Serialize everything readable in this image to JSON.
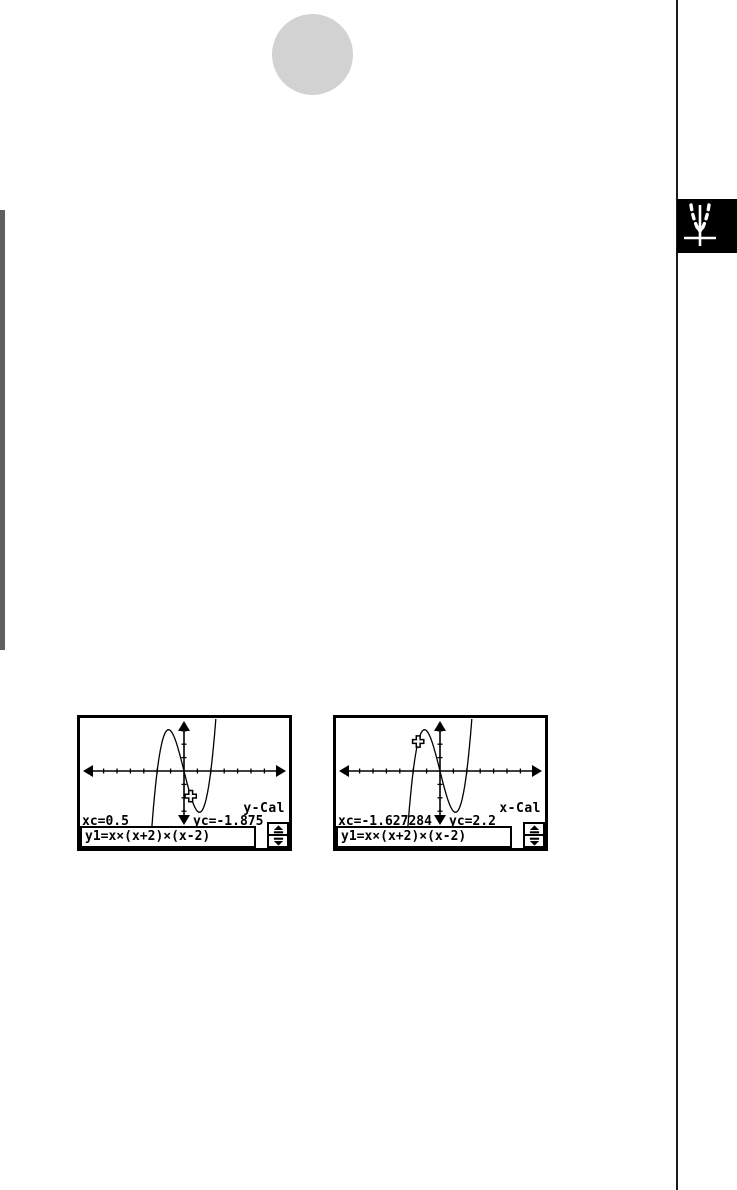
{
  "page": {
    "background": "#ffffff",
    "decorations": {
      "dot_color": "#d2d2d2",
      "side_tab_color": "#606060",
      "rule_color": "#1a1a1a",
      "chapter_tab_bg": "#000000",
      "chapter_tab_icon": "parabola-graph-icon"
    }
  },
  "screens": [
    {
      "trace_label": "y-Cal",
      "xc": "xc=0.5",
      "yc": "yc=-1.875",
      "formula": "y1=x×(x+2)×(x-2)",
      "cursor": {
        "x": 0.5,
        "y": -1.875
      },
      "icons": {
        "cursor": "trace-cursor-icon",
        "scroll_up": "scroll-up-icon",
        "scroll_down": "scroll-down-icon"
      }
    },
    {
      "trace_label": "x-Cal",
      "xc": "xc=-1.627284",
      "yc": "yc=2.2",
      "formula": "y1=x×(x+2)×(x-2)",
      "cursor": {
        "x": -1.627284,
        "y": 2.2
      },
      "icons": {
        "cursor": "trace-cursor-icon",
        "scroll_up": "scroll-up-icon",
        "scroll_down": "scroll-down-icon"
      }
    }
  ],
  "graph": {
    "poly": [
      1,
      0,
      -4,
      0
    ],
    "px_per_unit": 13.4,
    "origin_px": {
      "x": 104,
      "y": 53
    },
    "x_tick_interval": 1,
    "y_tick_interval": 1
  },
  "chart_data": [
    {
      "type": "line",
      "title": "Graph-to-Table trace screen (y-Cal)",
      "function": "y1=x×(x+2)×(x-2)",
      "roots": [
        -2,
        0,
        2
      ],
      "trace_point": {
        "xc": 0.5,
        "yc": -1.875
      },
      "xlim": [
        -7.7,
        7.7
      ],
      "ylim": [
        -4.1,
        3.9
      ],
      "tick_interval": 1,
      "grid": false,
      "annotations": [
        "y-Cal",
        "xc=0.5",
        "yc=-1.875"
      ]
    },
    {
      "type": "line",
      "title": "Graph-to-Table trace screen (x-Cal)",
      "function": "y1=x×(x+2)×(x-2)",
      "roots": [
        -2,
        0,
        2
      ],
      "trace_point": {
        "xc": -1.627284,
        "yc": 2.2
      },
      "xlim": [
        -7.7,
        7.7
      ],
      "ylim": [
        -4.1,
        3.9
      ],
      "tick_interval": 1,
      "grid": false,
      "annotations": [
        "x-Cal",
        "xc=-1.627284",
        "yc=2.2"
      ]
    }
  ]
}
